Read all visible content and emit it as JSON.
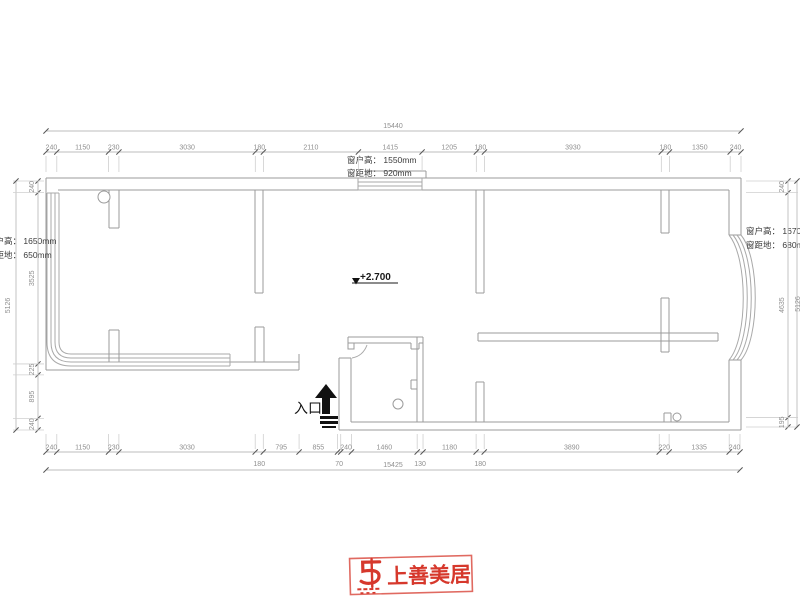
{
  "drawing": {
    "annotations": {
      "top_window": {
        "line1": "窗户高： 1550mm",
        "line2": "窗距地：  920mm"
      },
      "left_window": {
        "line1": "窗户高： 1650mm",
        "line2": "窗距地：  650mm"
      },
      "right_window": {
        "line1": "窗户高： 1670mm",
        "line2": "窗距地：  680mm"
      },
      "elevation": "+2.700",
      "entrance": "入口"
    },
    "dimensions": {
      "top": {
        "segments": [
          240,
          1150,
          230,
          3030,
          180,
          2110,
          1415,
          1205,
          180,
          3930,
          180,
          1350,
          240
        ],
        "total": "15440"
      },
      "bottom": {
        "segments": [
          240,
          1150,
          230,
          3030,
          180,
          795,
          855,
          70,
          240,
          1460,
          130,
          1180,
          180,
          3890,
          220,
          1335,
          240
        ],
        "total": "15425"
      },
      "left": {
        "segments": [
          240,
          3525,
          225,
          895,
          240
        ],
        "total": "5126"
      },
      "right": {
        "segments": [
          240,
          4635,
          195
        ],
        "total": "5126"
      }
    },
    "logo": {
      "text": "上善美居",
      "color": "#d6382c"
    }
  }
}
